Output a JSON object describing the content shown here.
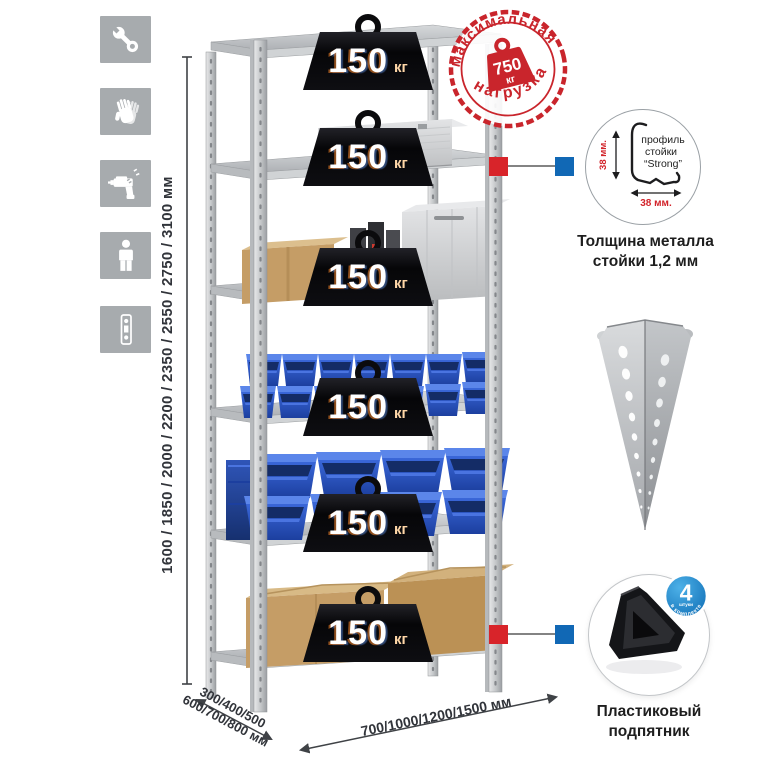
{
  "page": {
    "background": "#ffffff",
    "description": "Metal shelving rack product infographic"
  },
  "sidebar": {
    "icons": [
      {
        "name": "wrench-icon"
      },
      {
        "name": "gloves-icon"
      },
      {
        "name": "drill-icon"
      },
      {
        "name": "person-icon"
      },
      {
        "name": "post-profile-icon"
      }
    ]
  },
  "dimensions": {
    "height_label": "1600 / 1850 / 2000 / 2200 / 2350 / 2550 / 2750 / 3100 мм",
    "depth_line1": "300/400/500",
    "depth_line2": "600/700/800 мм",
    "width_label": "700/1000/1200/1500 мм"
  },
  "weight_badge": {
    "value": "150",
    "unit": "кг",
    "count_on_rack": 6
  },
  "stamp": {
    "arc_top": "максимальная",
    "arc_bottom": "нагрузка",
    "value": "750",
    "unit": "кг",
    "color": "#c9252c"
  },
  "profile_detail": {
    "text_line1": "профиль",
    "text_line2": "стойки",
    "text_line3": "“Strong”",
    "dim_vertical": "38 мм.",
    "dim_horizontal": "38 мм.",
    "caption_line1": "Толщина металла",
    "caption_line2": "стойки 1,2 мм"
  },
  "foot_detail": {
    "badge_value": "4",
    "badge_small": "штуки",
    "badge_arc": "в комплекте",
    "caption_line1": "Пластиковый",
    "caption_line2": "подпятник"
  },
  "colors": {
    "tile_gray": "#a7abae",
    "marker_red": "#d8242a",
    "marker_blue": "#1168b5",
    "stamp_red": "#c9252c",
    "bin_blue": "#2a55c4",
    "badge_blue": "#0e6cb4",
    "cardboard": "#c59d66",
    "metal_gray": "#c9ccce",
    "dim_text": "#31343a"
  }
}
